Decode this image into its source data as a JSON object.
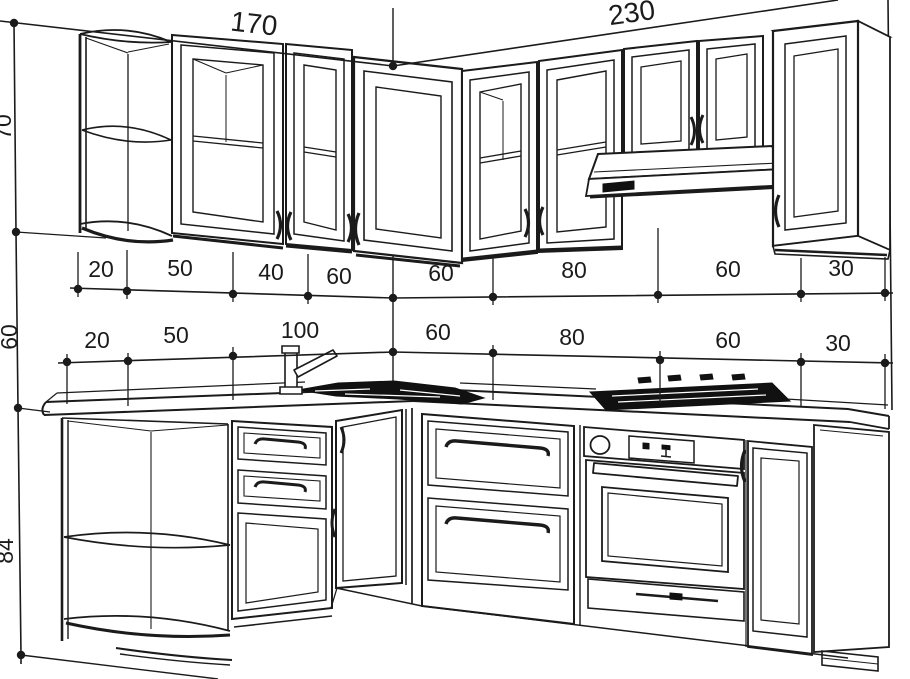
{
  "drawing": {
    "kind": "kitchen cabinet perspective drawing with dimensions",
    "colors": {
      "ink": "#1b1b1b",
      "background": "#ffffff",
      "fixture_fill": "#111111"
    },
    "dims": {
      "top": [
        "170",
        "230"
      ],
      "upper_row": [
        "20",
        "50",
        "40",
        "60",
        "60",
        "80",
        "60",
        "30"
      ],
      "lower_row": [
        "20",
        "50",
        "100",
        "60",
        "80",
        "60",
        "30"
      ],
      "left_col": [
        "70",
        "60",
        "84"
      ]
    }
  }
}
